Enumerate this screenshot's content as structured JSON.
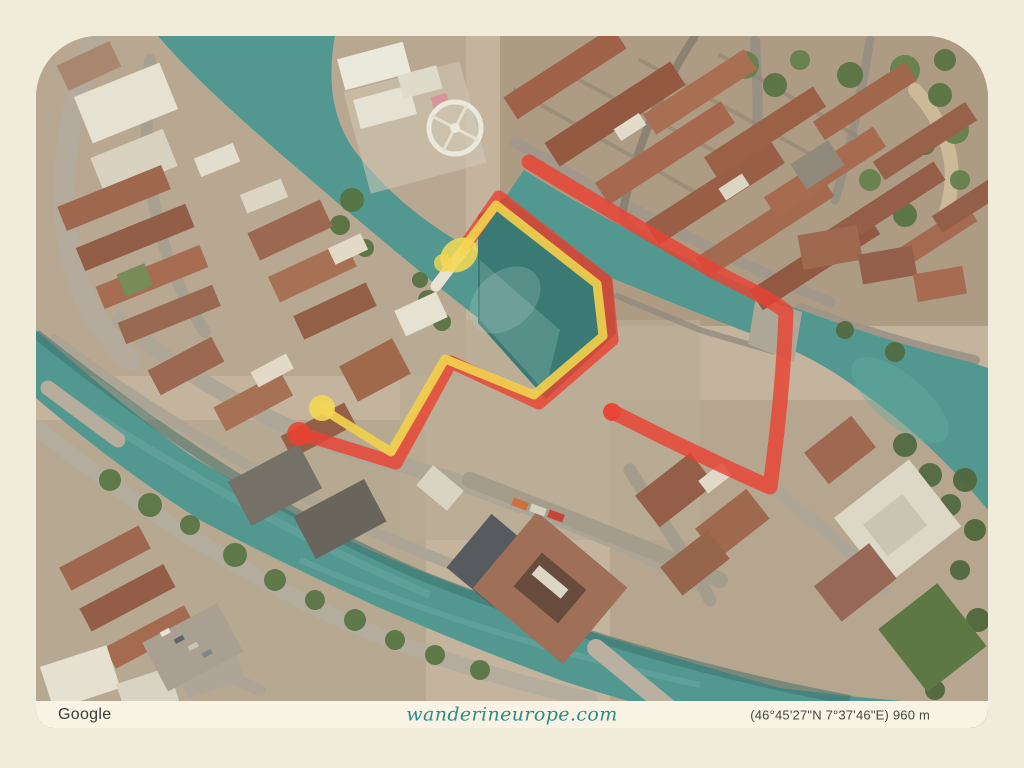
{
  "attribution": {
    "provider": "Google",
    "website": "wanderineurope.com",
    "coordinates": "(46°45'27\"N 7°37'46\"E) 960 m"
  },
  "map": {
    "type": "satellite-photo",
    "water_color": "#47948e",
    "routes": {
      "red": {
        "name": "red-route",
        "color": "#ea3829"
      },
      "yellow": {
        "name": "yellow-route",
        "color": "#f3cf45"
      }
    },
    "markers": [
      {
        "name": "yellow-bridge-marker",
        "shape": "blob",
        "color": "#f5d74f"
      },
      {
        "name": "yellow-street-marker",
        "shape": "circle",
        "color": "#f5d74f"
      },
      {
        "name": "red-endpoint-west",
        "shape": "circle",
        "color": "#ea3829"
      },
      {
        "name": "red-endpoint-east",
        "shape": "circle",
        "color": "#ea3829"
      }
    ]
  },
  "frame": {
    "color": "#f1ebda",
    "bar_color": "#f8f3e4"
  }
}
